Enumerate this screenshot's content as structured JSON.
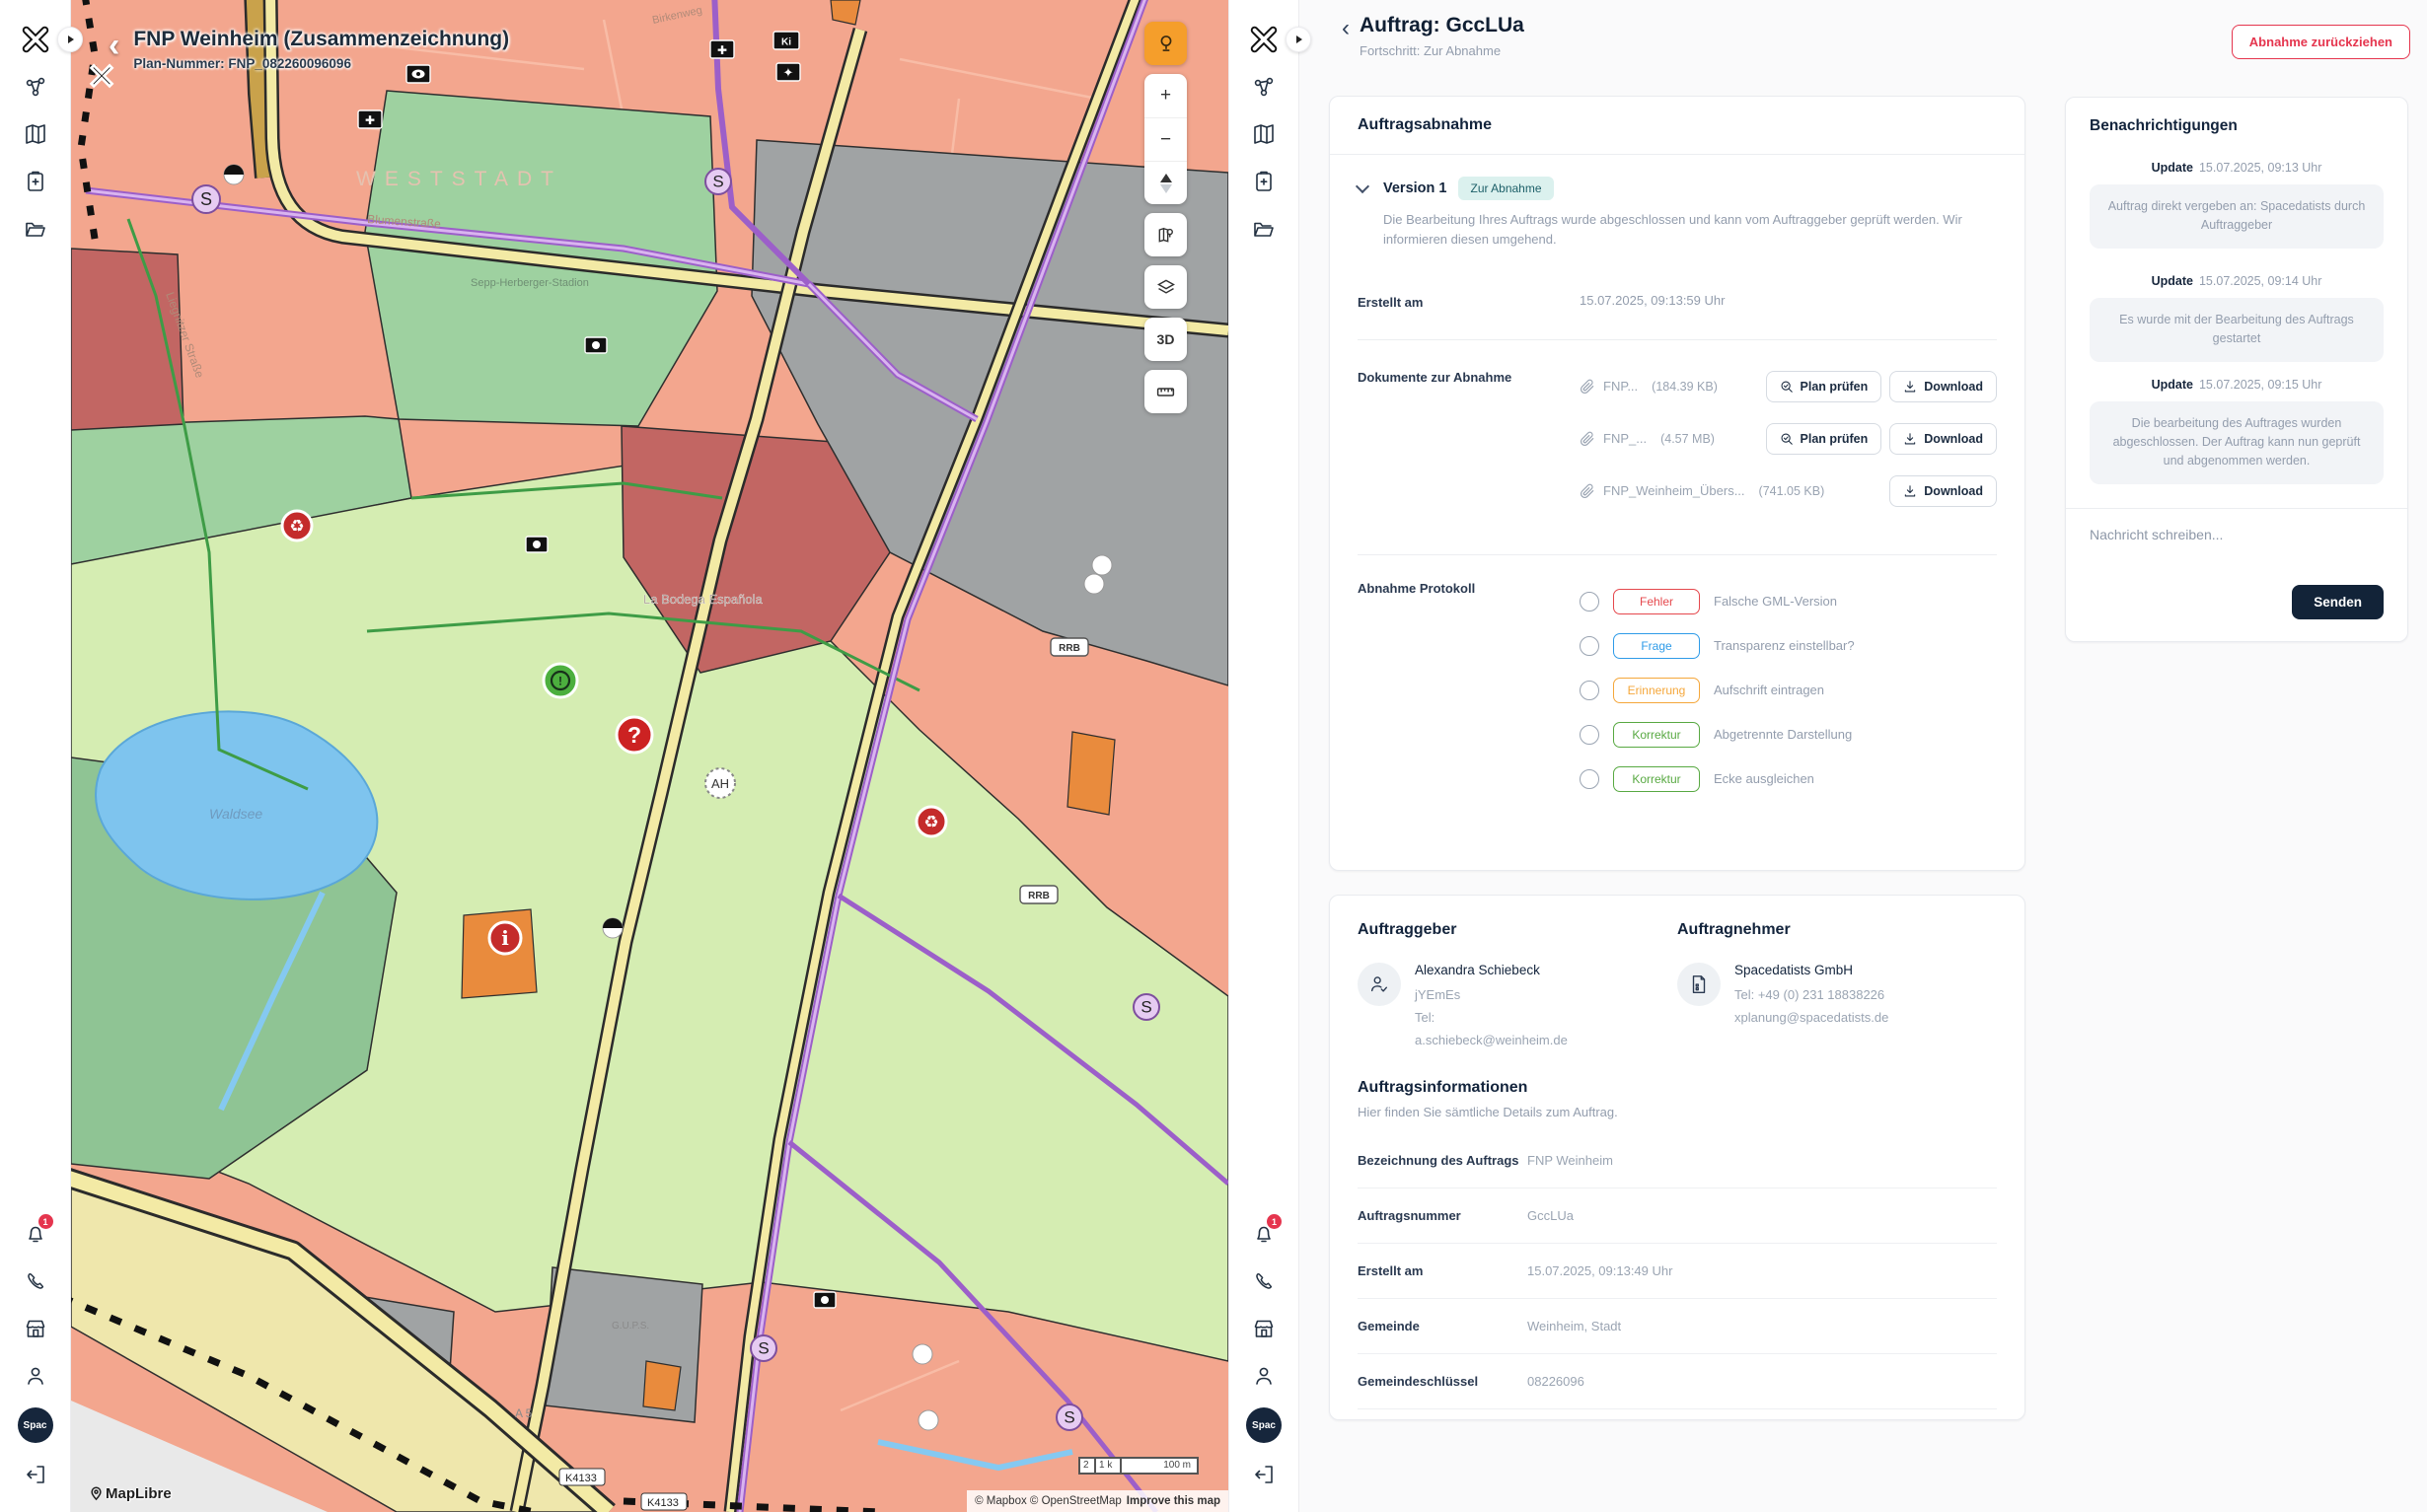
{
  "map": {
    "title": "FNP Weinheim (Zusammenzeichnung)",
    "plan_number": "Plan-Nummer: FNP_082260096096",
    "labels": {
      "district": "WESTSTADT",
      "lake": "Waldsee",
      "restaurant": "La Bodega Española",
      "stadium": "Sepp-Herberger-Stadion",
      "street1": "Blumenstraße",
      "street2": "Liegnitzer Straße",
      "street3": "Birkenweg",
      "motorway": "A 5",
      "road_k1": "K4133",
      "road_k2": "K4133",
      "area": "G.U.P.S.",
      "rrb1": "RRB",
      "rrb2": "RRB",
      "ah": "AH",
      "sbahn": "S",
      "ki": "Ki"
    },
    "controls": {
      "three_d": "3D"
    },
    "scale_small": "2",
    "scale_mid": "1 k",
    "scale_label": "100 m",
    "attribution": "© Mapbox © OpenStreetMap",
    "improve_link": "Improve this map",
    "maplibre": "MapLibre"
  },
  "sidebar": {
    "avatar": "Spac",
    "bell_badge": "1"
  },
  "header": {
    "title": "Auftrag: GccLUa",
    "subtitle": "Fortschritt: Zur Abnahme",
    "withdraw_button": "Abnahme zurückziehen"
  },
  "acceptance": {
    "title": "Auftragsabnahme",
    "version": "Version 1",
    "status_badge": "Zur Abnahme",
    "description": "Die Bearbeitung Ihres Auftrags wurde abgeschlossen und kann vom Auftraggeber geprüft werden. Wir informieren diesen umgehend.",
    "created_label": "Erstellt am",
    "created_value": "15.07.2025, 09:13:59 Uhr",
    "documents_label": "Dokumente zur Abnahme",
    "documents": [
      {
        "name": "FNP...",
        "size": "(184.39 KB)"
      },
      {
        "name": "FNP_...",
        "size": "(4.57 MB)"
      },
      {
        "name": "FNP_Weinheim_Übers...",
        "size": "(741.05 KB)"
      }
    ],
    "check_label": "Plan prüfen",
    "download_label": "Download",
    "protocol_label": "Abnahme Protokoll",
    "protocol": [
      {
        "tag": "Fehler",
        "color": "#e5484d",
        "text": "Falsche GML-Version"
      },
      {
        "tag": "Frage",
        "color": "#2e9be8",
        "text": "Transparenz einstellbar?"
      },
      {
        "tag": "Erinnerung",
        "color": "#f5a73b",
        "text": "Aufschrift eintragen"
      },
      {
        "tag": "Korrektur",
        "color": "#58a942",
        "text": "Abgetrennte Darstellung"
      },
      {
        "tag": "Korrektur",
        "color": "#58a942",
        "text": "Ecke ausgleichen"
      }
    ]
  },
  "parties": {
    "client_label": "Auftraggeber",
    "client": {
      "name": "Alexandra Schiebeck",
      "line2": "jYEmEs",
      "line3": "Tel:",
      "line4": "a.schiebeck@weinheim.de"
    },
    "contractor_label": "Auftragnehmer",
    "contractor": {
      "name": "Spacedatists GmbH",
      "line2": "Tel: +49 (0) 231 18838226",
      "line3": "xplanung@spacedatists.de"
    }
  },
  "order_info": {
    "title": "Auftragsinformationen",
    "subtitle": "Hier finden Sie sämtliche Details zum Auftrag.",
    "rows": [
      {
        "label": "Bezeichnung des Auftrags",
        "value": "FNP Weinheim"
      },
      {
        "label": "Auftragsnummer",
        "value": "GccLUa"
      },
      {
        "label": "Erstellt am",
        "value": "15.07.2025, 09:13:49 Uhr"
      },
      {
        "label": "Gemeinde",
        "value": "Weinheim, Stadt"
      },
      {
        "label": "Gemeindeschlüssel",
        "value": "08226096"
      }
    ]
  },
  "notifications": {
    "title": "Benachrichtigungen",
    "items": [
      {
        "tag": "Update",
        "time": "15.07.2025, 09:13 Uhr",
        "text": "Auftrag direkt vergeben an: Spacedatists durch Auftraggeber"
      },
      {
        "tag": "Update",
        "time": "15.07.2025, 09:14 Uhr",
        "text": "Es wurde mit der Bearbeitung des Auftrags gestartet"
      },
      {
        "tag": "Update",
        "time": "15.07.2025, 09:15 Uhr",
        "text": "Die bearbeitung des Auftrages wurden abgeschlossen. Der Auftrag kann nun geprüft und abgenommen werden."
      }
    ],
    "message_placeholder": "Nachricht schreiben...",
    "send_button": "Senden"
  }
}
